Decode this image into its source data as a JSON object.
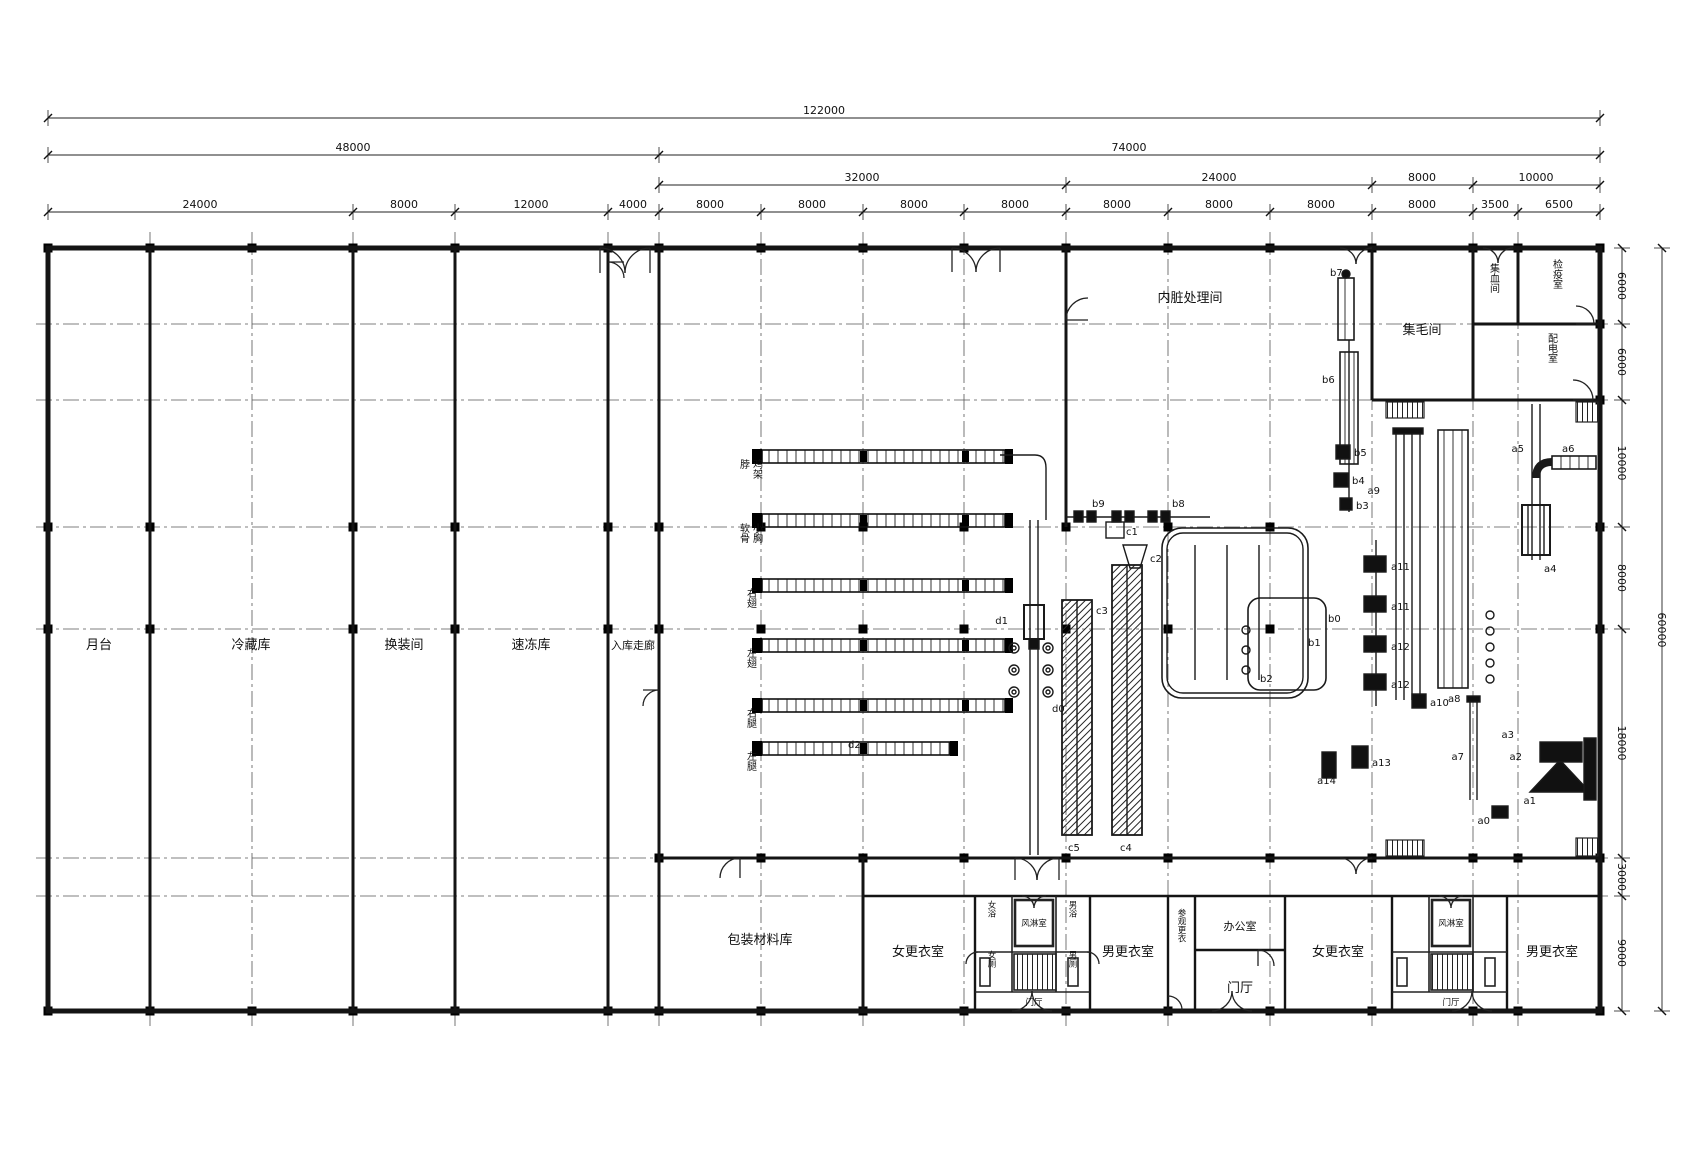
{
  "drawing": {
    "type": "factory floor plan",
    "line_color": "#111111",
    "grid_color": "#555555",
    "background": "#ffffff"
  },
  "dimensions": {
    "row1": [
      "122000"
    ],
    "row2": [
      "48000",
      "74000"
    ],
    "row3": [
      "32000",
      "24000",
      "8000",
      "10000"
    ],
    "row4": [
      "24000",
      "8000",
      "12000",
      "4000",
      "8000",
      "8000",
      "8000",
      "8000",
      "8000",
      "8000",
      "8000",
      "8000",
      "3500",
      "6500"
    ],
    "right": [
      "6000",
      "6000",
      "10000",
      "8000",
      "18000",
      "3000",
      "9000"
    ],
    "right_overall": "60000"
  },
  "rooms": {
    "platform": "月台",
    "cold_storage": "冷藏库",
    "changing": "换装间",
    "quick_freeze": "速冻库",
    "entry_corridor": "入库走廊",
    "viscera": "内脏处理间",
    "feather": "集毛间",
    "blood": "集血间",
    "quarantine": "检疫室",
    "power": "配电室",
    "packaging": "包装材料库",
    "women_change_1": "女更衣室",
    "men_change_1": "男更衣室",
    "women_change_2": "女更衣室",
    "men_change_2": "男更衣室",
    "air_shower_1": "风淋室",
    "air_shower_2": "风淋室",
    "women_shower": "女浴",
    "men_shower": "男浴",
    "women_wc": "女厕",
    "men_wc": "男厕",
    "hall_small_1": "门厅",
    "hall_small_2": "门厅",
    "hall_main": "门厅",
    "office": "办公室",
    "visitor_change": "参观更衣"
  },
  "conveyor_labels": [
    "脖",
    "鸡架",
    "软骨",
    "小胸",
    "右翅",
    "左翅",
    "右腿",
    "左腿"
  ],
  "equipment": {
    "a0": "a0",
    "a1": "a1",
    "a2": "a2",
    "a3": "a3",
    "a4": "a4",
    "a5": "a5",
    "a6": "a6",
    "a7": "a7",
    "a8": "a8",
    "a9": "a9",
    "a10": "a10",
    "a11": "a11",
    "a12": "a12",
    "a13": "a13",
    "a14": "a14",
    "b0": "b0",
    "b1": "b1",
    "b2": "b2",
    "b3": "b3",
    "b4": "b4",
    "b5": "b5",
    "b6": "b6",
    "b7": "b7",
    "b8": "b8",
    "b9": "b9",
    "c1": "c1",
    "c2": "c2",
    "c3": "c3",
    "c4": "c4",
    "c5": "c5",
    "d0": "d0",
    "d1": "d1",
    "d2": "d2"
  }
}
